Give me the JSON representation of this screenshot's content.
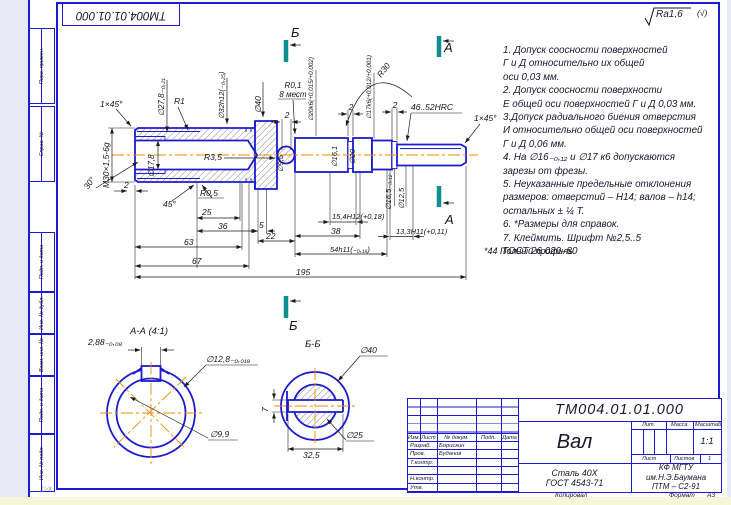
{
  "page": {
    "accent_blue": "#1b1bd0",
    "centerline_orange": "#f08c00",
    "marker_teal": "#0d8f8f"
  },
  "top_left_box": {
    "text": "ТМ004.01.01.000"
  },
  "roughness": {
    "value": "Ra1,6",
    "suffix": "(√)"
  },
  "frame": {
    "left_fields": [
      {
        "label": "Перв. примен.",
        "y": 26,
        "h": 76
      },
      {
        "label": "Справ. №",
        "y": 104,
        "h": 76
      },
      {
        "label": "Подп. и дата",
        "y": 230,
        "h": 60
      },
      {
        "label": "Инв. № дубл.",
        "y": 290,
        "h": 42
      },
      {
        "label": "Взам. инв. №",
        "y": 332,
        "h": 42
      },
      {
        "label": "Подп. и дата",
        "y": 374,
        "h": 58
      },
      {
        "label": "Инв. № подл.",
        "y": 432,
        "h": 58
      }
    ]
  },
  "notes": {
    "lines": [
      "1. Допуск соосности поверхностей",
      "Г и Д относительно их общей",
      "оси 0,03 мм.",
      "2. Допуск соосности поверхности",
      "Е общей оси поверхностей Г и Д 0,03 мм.",
      "3.Допуск радиального биения отверстия",
      "И относительно общей оси поверхностей",
      "Г и Д 0,06 мм.",
      "4. На ∅16₋₀,₁₂ и ∅17 к6 допускаются",
      "зарезы от фрезы.",
      "5. Неуказанные предельные отклонения",
      "размеров: отверстий – H14; валов – h14;",
      "остальных ± ¼ Т.",
      "6. *Размеры для справок.",
      "7. Клеймить. Шрифт №2,5..5",
      "ГОСТ 26.020–80"
    ]
  },
  "drawing": {
    "labels": [
      {
        "t": "1×45°",
        "x": 100,
        "y": 107,
        "s": 8.5
      },
      {
        "t": "М30×1,5-6g",
        "x": 109,
        "y": 188,
        "r": -90,
        "s": 8.5
      },
      {
        "t": "30°",
        "x": 88,
        "y": 190,
        "r": -55,
        "s": 8.5
      },
      {
        "t": "∅27,8₋₀,₂₁",
        "x": 164,
        "y": 116,
        "r": -90,
        "s": 8
      },
      {
        "t": "R1",
        "x": 174,
        "y": 104,
        "s": 8.5
      },
      {
        "t": "∅32h12(₋₀,₂₅)",
        "x": 224,
        "y": 119,
        "r": -90,
        "s": 7.5
      },
      {
        "t": "∅40",
        "x": 261,
        "y": 113,
        "r": -90,
        "s": 8.5
      },
      {
        "t": "∅17,8",
        "x": 154,
        "y": 177,
        "r": -90,
        "s": 8
      },
      {
        "t": "R3,5",
        "x": 204,
        "y": 160,
        "s": 8.5
      },
      {
        "t": "2",
        "x": 124,
        "y": 188,
        "s": 8.5
      },
      {
        "t": "45°",
        "x": 163,
        "y": 207,
        "s": 8.5
      },
      {
        "t": "R0,5",
        "x": 200,
        "y": 196,
        "s": 8.5
      },
      {
        "t": "25",
        "x": 202,
        "y": 215,
        "s": 8.5
      },
      {
        "t": "36",
        "x": 218,
        "y": 229,
        "s": 8.5
      },
      {
        "t": "5",
        "x": 259,
        "y": 228,
        "s": 8.5
      },
      {
        "t": "63",
        "x": 184,
        "y": 245,
        "s": 8.5
      },
      {
        "t": "22",
        "x": 266,
        "y": 239,
        "s": 8.5
      },
      {
        "t": "67",
        "x": 192,
        "y": 264,
        "s": 8.5
      },
      {
        "t": "195",
        "x": 296,
        "y": 275,
        "s": 8.5
      },
      {
        "t": "R0,1",
        "x": 293,
        "y": 88,
        "a": "m",
        "s": 8
      },
      {
        "t": "8 мест",
        "x": 293,
        "y": 97,
        "a": "m",
        "s": 8
      },
      {
        "t": "2",
        "x": 287,
        "y": 118,
        "a": "m",
        "s": 8.5
      },
      {
        "t": "∅20k6(+0,015/+0,002)",
        "x": 313,
        "y": 121,
        "r": -90,
        "s": 6.3
      },
      {
        "t": "2",
        "x": 351,
        "y": 110,
        "a": "m",
        "s": 8.5
      },
      {
        "t": "∅17k6(+0,012/+0,001)",
        "x": 371,
        "y": 119,
        "r": -90,
        "s": 6.3
      },
      {
        "t": "2",
        "x": 395,
        "y": 108,
        "a": "m",
        "s": 8.5
      },
      {
        "t": "R30",
        "x": 381,
        "y": 78,
        "r": -52,
        "s": 8.5
      },
      {
        "t": "46..52HRC",
        "x": 411,
        "y": 110,
        "s": 8.5
      },
      {
        "t": "1×45°",
        "x": 474,
        "y": 121,
        "s": 8.5
      },
      {
        "t": "∅9,5",
        "x": 283,
        "y": 172,
        "r": -90,
        "s": 7.5
      },
      {
        "t": "∅16,1",
        "x": 337,
        "y": 167,
        "r": -90,
        "s": 7.5
      },
      {
        "t": "∅20",
        "x": 355,
        "y": 164,
        "r": -90,
        "s": 7.5
      },
      {
        "t": "∅16,5₋₀,₁₂",
        "x": 391,
        "y": 210,
        "r": -90,
        "s": 7.5
      },
      {
        "t": "∅12,5",
        "x": 404,
        "y": 209,
        "r": -90,
        "s": 7.5
      },
      {
        "t": "15,4H12(+0,18)",
        "x": 332,
        "y": 219,
        "s": 7.5
      },
      {
        "t": "38",
        "x": 331,
        "y": 234,
        "s": 8.5
      },
      {
        "t": "13,3H11(+0,11)",
        "x": 396,
        "y": 234,
        "s": 7.5
      },
      {
        "t": "54h11(₋₀,₁₉)",
        "x": 330,
        "y": 252,
        "s": 7.5
      },
      {
        "t": "*44 Полный профиль",
        "x": 484,
        "y": 254,
        "s": 9
      },
      {
        "t": "Б",
        "x": 291,
        "y": 37,
        "s": 13
      },
      {
        "t": "Б",
        "x": 289,
        "y": 330,
        "s": 13
      },
      {
        "t": "А",
        "x": 444,
        "y": 52,
        "s": 13
      },
      {
        "t": "А",
        "x": 445,
        "y": 224,
        "s": 13
      },
      {
        "t": "А-А (4:1)",
        "x": 130,
        "y": 334,
        "s": 9.5
      },
      {
        "t": "2,88₋₀,₀₈",
        "x": 88,
        "y": 345,
        "s": 8.5
      },
      {
        "t": "∅12,8₋₀,₀₁₈",
        "x": 206,
        "y": 362,
        "s": 8.5
      },
      {
        "t": "∅9,9",
        "x": 210,
        "y": 437,
        "s": 8.5
      },
      {
        "t": "Б-Б",
        "x": 305,
        "y": 347,
        "s": 9.5
      },
      {
        "t": "∅40",
        "x": 360,
        "y": 353,
        "s": 8.5
      },
      {
        "t": "∅25",
        "x": 346,
        "y": 438,
        "s": 8.5
      },
      {
        "t": "7",
        "x": 268,
        "y": 412,
        "r": -90,
        "s": 8.5
      },
      {
        "t": "32,5",
        "x": 303,
        "y": 458,
        "s": 8.5
      }
    ]
  },
  "title_block": {
    "doc_number": "ТМ004.01.01.000",
    "part_name": "Вал",
    "material_line1": "Сталь 40Х",
    "material_line2": "ГОСТ 4543-71",
    "header_cols": [
      "Изм.",
      "Лист",
      "№ докум.",
      "Подп.",
      "Дата"
    ],
    "rows": [
      {
        "role": "Разраб.",
        "name": "Борискин"
      },
      {
        "role": "Пров.",
        "name": "Буданов"
      },
      {
        "role": "Т.контр.",
        "name": ""
      },
      {
        "role": "",
        "name": ""
      },
      {
        "role": "Н.контр.",
        "name": ""
      },
      {
        "role": "Утв.",
        "name": ""
      }
    ],
    "lit_label": "Лит.",
    "mass_label": "Масса",
    "scale_label": "Масштаб",
    "scale_value": "1:1",
    "sheet_label": "Лист",
    "sheets_label": "Листов",
    "sheets_value": "1",
    "org_line1": "КФ МГТУ им.Н.Э.Баумана",
    "org_line2": "ПТМ – С2-91",
    "copied_label": "Копировал",
    "format_label": "Формат",
    "format_value": "А3"
  }
}
